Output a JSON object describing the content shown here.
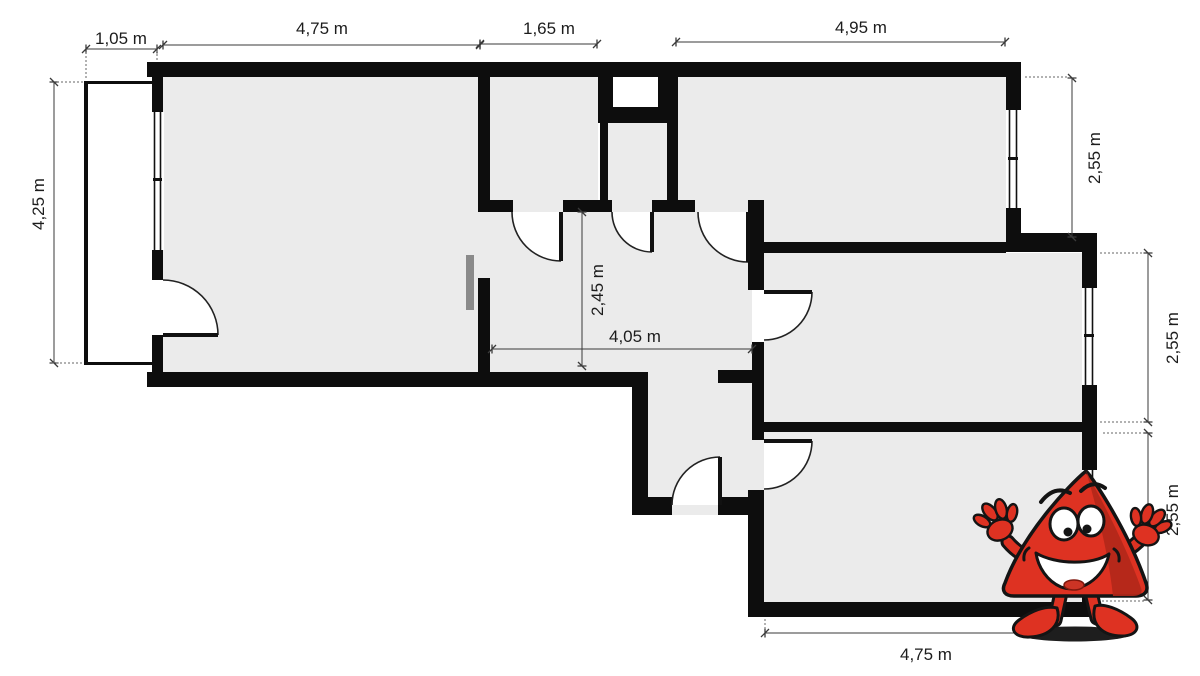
{
  "diagram": {
    "type": "apartment-floor-plan",
    "unit": "m"
  },
  "dimensions": {
    "balcony_width": "1,05 m",
    "living_room_width": "4,75 m",
    "bathroom_width": "1,65 m",
    "bedroom_top_width": "4,95 m",
    "left_side_height": "4,25 m",
    "bedroom_top_height": "2,55 m",
    "bedroom_middle_height": "2,55 m",
    "bedroom_bottom_height": "2,55 m",
    "hallway_depth": "2,45 m",
    "hallway_width": "4,05 m",
    "bedroom_bottom_width": "4,75 m"
  },
  "colors": {
    "background": "#ffffff",
    "room_fill": "#ebebeb",
    "wall": "#0d0d0d",
    "dimension_line": "#3a3a3a",
    "label_text": "#1c1c1c",
    "radiator": "#8a8a8a",
    "mascot_body": "#de3222",
    "mascot_shade": "#b1271a",
    "mascot_outline": "#141414"
  },
  "mascot": {
    "name": "red-triangle-mascot"
  }
}
